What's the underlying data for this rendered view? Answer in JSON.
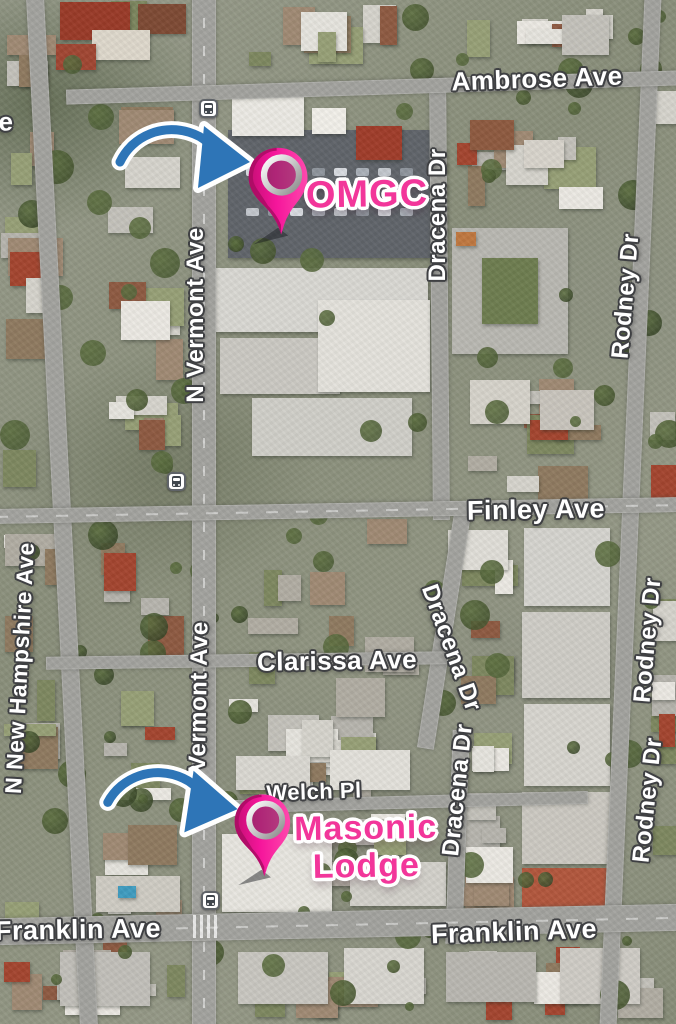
{
  "map": {
    "street_labels": [
      {
        "text": "Ambrose Ave"
      },
      {
        "text": "N Vermont Ave"
      },
      {
        "text": "Dracena Dr"
      },
      {
        "text": "Rodney Dr"
      },
      {
        "text": "Finley Ave"
      },
      {
        "text": "N New Hampshire Ave"
      },
      {
        "text": "N Vermont Ave"
      },
      {
        "text": "Clarissa Ave"
      },
      {
        "text": "Dracena Dr"
      },
      {
        "text": "Dracena Dr"
      },
      {
        "text": "Welch Pl"
      },
      {
        "text": "Rodney Dr"
      },
      {
        "text": "Rodney Dr"
      },
      {
        "text": "Franklin Ave"
      },
      {
        "text": "Franklin Ave"
      },
      {
        "text": "e"
      }
    ],
    "annotations": {
      "pin1_label": "OMGC",
      "pin2_label": "Masonic Lodge"
    },
    "icons": {
      "transit_station": "transit-station-icon",
      "map_pin": "map-pin-icon",
      "arrow": "curved-arrow-icon"
    },
    "colors": {
      "pin_pink": "#f5169b",
      "pin_dark_edge": "#a90c63",
      "annotation_pink": "#f2369a",
      "arrow_blue": "#2e75b7",
      "street_label_outline": "#3f4043"
    }
  }
}
